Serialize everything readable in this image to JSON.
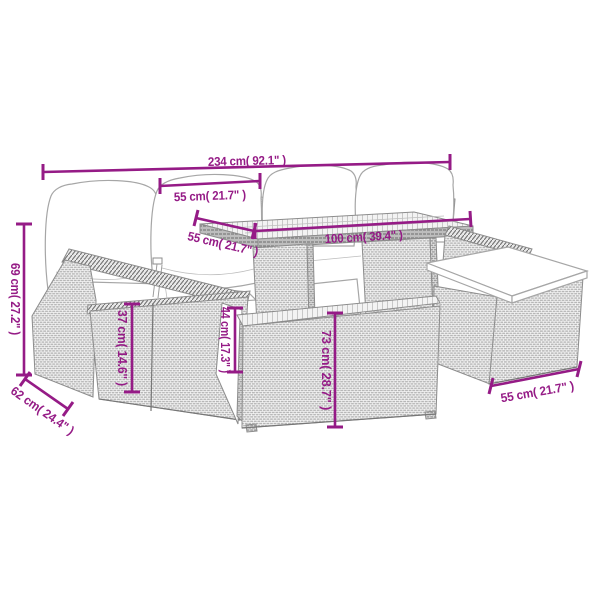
{
  "diagram": {
    "kind": "product-dimension-diagram",
    "background": "#ffffff",
    "colors": {
      "dimension_accent": "#951b86",
      "furniture_outline": "#8c8c8c",
      "cushion_fill": "#ffffff"
    },
    "dimensions": [
      {
        "id": "overall-width",
        "label": "234 cm( 92.1\" )"
      },
      {
        "id": "seat-width",
        "label": "55 cm( 21.7\" )"
      },
      {
        "id": "tabletop-depth",
        "label": "55 cm( 21.7\" )"
      },
      {
        "id": "tabletop-width",
        "label": "100 cm( 39.4\" )"
      },
      {
        "id": "backrest-height",
        "label": "69 cm( 27.2\" )"
      },
      {
        "id": "seat-height",
        "label": "37 cm( 14.6\" )"
      },
      {
        "id": "side-height",
        "label": "44 cm( 17.3\" )"
      },
      {
        "id": "table-height",
        "label": "73 cm( 28.7\" )"
      },
      {
        "id": "seat-depth",
        "label": "62 cm( 24.4\" )"
      },
      {
        "id": "footstool-width",
        "label": "55 cm( 21.7\" )"
      }
    ]
  }
}
